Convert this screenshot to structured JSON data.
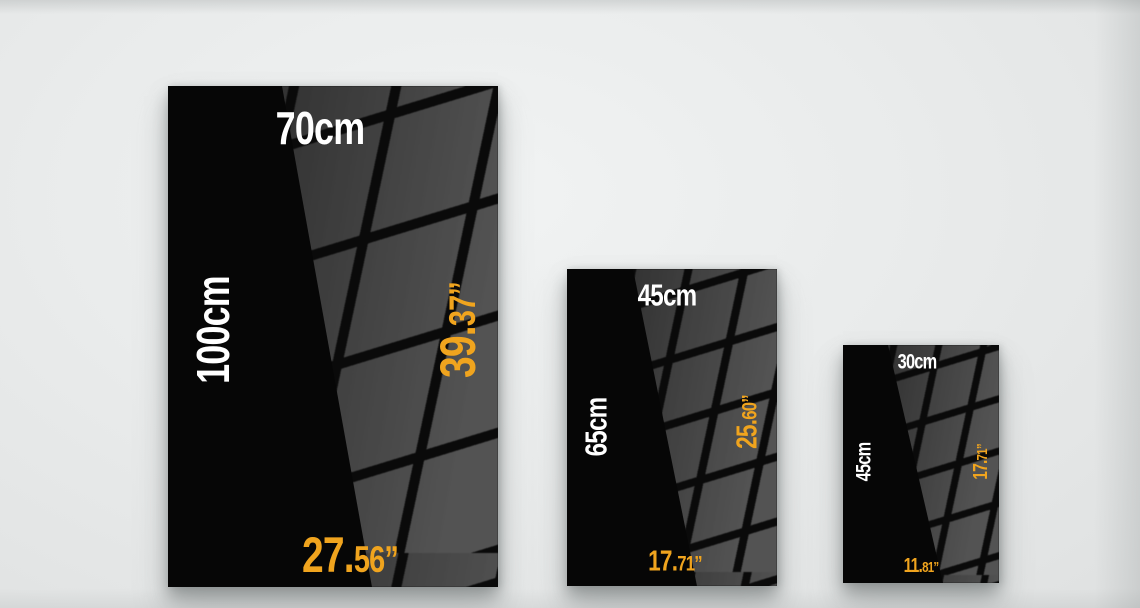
{
  "colors": {
    "wall_light": "#f1f3f3",
    "wall_dark": "#dfe1e1",
    "poster_black": "#060606",
    "reflection_gray": "#3f3f3f",
    "grid_line": "#0a0a0a",
    "text_white": "#ffffff",
    "accent_orange": "#f0a41e"
  },
  "posters": [
    {
      "id": "100x70cm",
      "width_cm": "70cm",
      "height_cm": "100cm",
      "height_in_main": "39.",
      "height_in_dec": "37”",
      "width_in_main": "27.",
      "width_in_dec": "56”"
    },
    {
      "id": "65x45cm",
      "width_cm": "45cm",
      "height_cm": "65cm",
      "height_in_main": "25.",
      "height_in_dec": "60”",
      "width_in_main": "17.",
      "width_in_dec": "71”"
    },
    {
      "id": "45x30cm",
      "width_cm": "30cm",
      "height_cm": "45cm",
      "height_in_main": "17.",
      "height_in_dec": "71”",
      "width_in_main": "11.",
      "width_in_dec": "81”"
    }
  ]
}
